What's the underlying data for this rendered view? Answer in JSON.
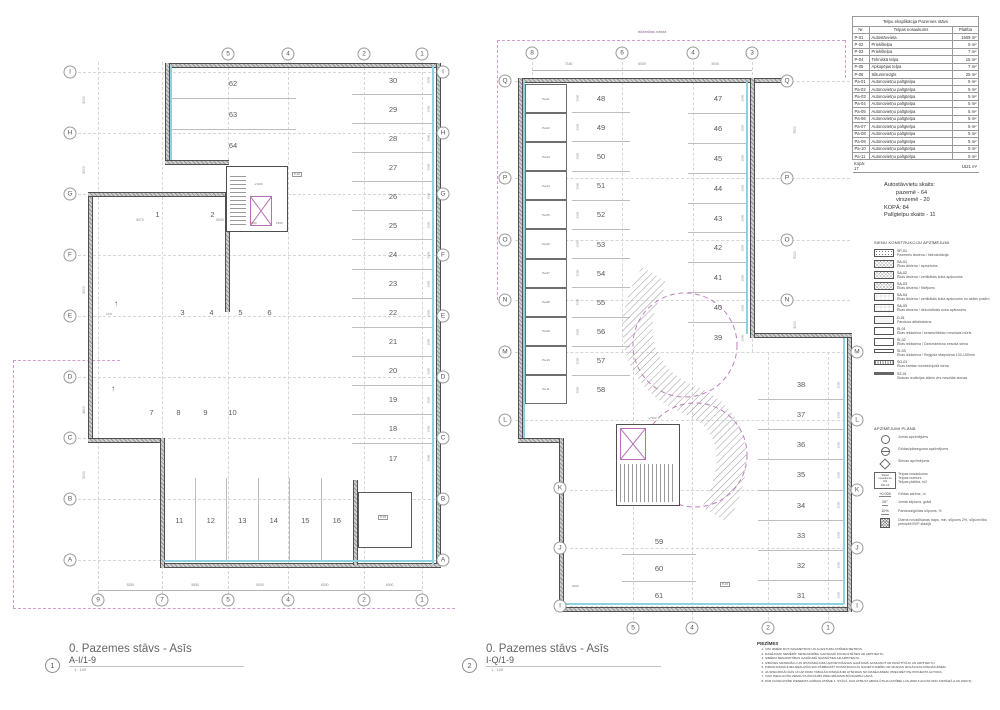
{
  "title_block_1": {
    "number": "1",
    "title": "0. Pazemes stāvs - Asīs",
    "drawing": "A-I/1-9",
    "scale": "1 : 100"
  },
  "title_block_2": {
    "number": "2",
    "title": "0. Pazemes stāvs - Asīs",
    "drawing": "I-Q/1-9",
    "scale": "1 : 100"
  },
  "room_table": {
    "title": "Telpu eksplikācija Pazemes stāvs",
    "headers": [
      "Nr.",
      "Telpas nosaukums",
      "Platība"
    ],
    "rows": [
      [
        "P-01",
        "Autostāvvieta",
        "1509 m²"
      ],
      [
        "P-02",
        "Priekštelpa",
        "5 m²"
      ],
      [
        "P-03",
        "Priekštelpa",
        "7 m²"
      ],
      [
        "P-04",
        "Tehniskā telpa",
        "15 m²"
      ],
      [
        "P-05",
        "Apkopējas telpa",
        "7 m²"
      ],
      [
        "P-06",
        "Siltummezgls",
        "25 m²"
      ],
      [
        "Pa-01",
        "Autonovietņu palīgtelpa",
        "5 m²"
      ],
      [
        "Pa-02",
        "Autonovietņu palīgtelpa",
        "5 m²"
      ],
      [
        "Pa-03",
        "Autonovietņu palīgtelpa",
        "5 m²"
      ],
      [
        "Pa-04",
        "Autonovietņu palīgtelpa",
        "5 m²"
      ],
      [
        "Pa-05",
        "Autonovietņu palīgtelpa",
        "5 m²"
      ],
      [
        "Pa-06",
        "Autonovietņu palīgtelpa",
        "5 m²"
      ],
      [
        "Pa-07",
        "Autonovietņu palīgtelpa",
        "5 m²"
      ],
      [
        "Pa-08",
        "Autonovietņu palīgtelpa",
        "5 m²"
      ],
      [
        "Pa-09",
        "Autonovietņu palīgtelpa",
        "5 m²"
      ],
      [
        "Pa-10",
        "Autonovietņu palīgtelpa",
        "5 m²"
      ],
      [
        "Pa-11",
        "Autonovietņu palīgtelpa",
        "5 m²"
      ]
    ],
    "footer": [
      "Kopā: 17",
      "",
      "1621 m²"
    ]
  },
  "counts": {
    "lines": [
      "Autostāvvietu skaits:",
      "pazemē - 64",
      "virszemē - 20",
      "KOPĀ: 84",
      "Palīgtelpu skaits - 11"
    ]
  },
  "wall_legend": {
    "title": "SIENU KONSTRUKCIJU APZĪMĒJUMI",
    "items": [
      {
        "code": "SP-01",
        "desc": "Pazemes ārsiena / hidroizolācija",
        "swatch": "sw-speckle"
      },
      {
        "code": "SA-01",
        "desc": "Ēkas ārsiena / apmetums",
        "swatch": "sw-cross"
      },
      {
        "code": "SA-02",
        "desc": "Ēkas ārsiena / vertikālais koka apšuvums",
        "swatch": "sw-cross"
      },
      {
        "code": "SA-03",
        "desc": "Ēkas ārsiena / flīzējums",
        "swatch": "sw-cross"
      },
      {
        "code": "SA-04",
        "desc": "Ēkas ārsiena / vertikālais koka apšuvums no abām pusēm",
        "swatch": "sw-circles"
      },
      {
        "code": "SA-05",
        "desc": "Ēkas ārsiena / dekoratīvais koka apšuvums",
        "swatch": "sw-circles"
      },
      {
        "code": "D-01",
        "desc": "Pandusa atbalstsiena",
        "swatch": "sw-light"
      },
      {
        "code": "SI-01",
        "desc": "Ēkas iekšsiena / keramzītbloku nesošais mūris",
        "swatch": "sw-lightdot"
      },
      {
        "code": "SI-02",
        "desc": "Ēkas iekšsiena / Dzelzsbetona nesošā siena",
        "swatch": "sw-lightdot"
      },
      {
        "code": "SI-03",
        "desc": "Ēkas iekšsiena / Reģipša starpsiena 100-150mm",
        "swatch": "sw-thin"
      },
      {
        "code": "SG-01",
        "desc": "Ēkas šahtas norobežojošā siena",
        "swatch": "sw-dotband"
      },
      {
        "code": "SZ-01",
        "desc": "Skaņas izolācijas slānis virs nesošās sienas",
        "swatch": "sw-solid"
      }
    ]
  },
  "plan_legend": {
    "title": "APZĪMĒJUMI PLĀNĀ",
    "items": [
      {
        "sym": "circle",
        "sym_text": "",
        "label": "Jumta apzīmējums"
      },
      {
        "sym": "circle2",
        "sym_text": "",
        "label": "Grīdas/pārseguma apzīmējums"
      },
      {
        "sym": "diamond",
        "sym_text": "",
        "label": "Sienas apzīmējums"
      },
      {
        "sym": "roombox",
        "sym_text": "Telpas nosaukums\nI-01\n100 m2",
        "label": "Telpas nosaukums\nTelpas numurs\nTelpas platība, m2"
      },
      {
        "sym": "text",
        "sym_text": "+0.000",
        "label": "Grīdas atzīme, m"
      },
      {
        "sym": "text",
        "sym_text": "26°",
        "label": "Jumta slīpums, grādi"
      },
      {
        "sym": "text",
        "sym_text": "10%",
        "label": "Pandusa/grīdas slīpums, %"
      },
      {
        "sym": "hatch",
        "sym_text": "",
        "label": "Ūdens novadīšanas traps, min. slīpums 2%, slīpumi tiks precizēti BVP stadijā"
      }
    ]
  },
  "notes": {
    "title": "PIEZĪMES",
    "items": [
      "VISI IZMĒRI DOTI MILIMETROS UN AUGSTUMA ATZĪMES METROS.",
      "RASĒJUMU NEMĒRĪT. NESKAIDRĪBU GADĪJUMĀ KONSULTĒTIES AR ARHITEKTU.",
      "IZMĒRU NESAKRITĪBAS GADĪJUMĀ SAZINĀTIES AR ARHITEKTU.",
      "IZBŪVES MATERIĀLU UN IZSTRĀDĀJUMU AIZVIETOŠANAS GADĪJUMĀ SASKAŅOT AR PASŪTĪTĀJU UN ARHITEKTU.",
      "PIRMS RISINĀJUMA REALIZĀCIJAS PĀRBAUDĪT KONSTRUKCIJU SAVIETOJAMĪBU AR SKAŅAS IZOLĀCIJAS RISINĀJUMIEM.",
      "JA SPECIFIKĀCIJĀS UN APJOMU TABULĀS RISINĀJUMI ATŠĶIRAS NO RASĒJUMIEM, PRECIZĒT PIE PROJEKTA AUTORA.",
      "VISU PIEGULOŠO ZEMJU PLĀNOJUMS PRECIZĒJAMS BŪVDARBU LAIKĀ.",
      "PAR ±0.000 ATZĪMI PIEŅEMTA GRĪDAS ATZĪME 1. STĀVĀ, KAS ATBILST ABSOLŪTAJAI ATZĪMEI LAS-2000,5 AUGSTUMU SISTĒMĀ (LAS 2000,5)."
    ]
  },
  "plan1": {
    "axes_left": [
      "I",
      "H",
      "G",
      "F",
      "E",
      "D",
      "C",
      "B",
      "A"
    ],
    "axes_right": [
      "I",
      "H",
      "G",
      "F",
      "E",
      "D",
      "C",
      "B",
      "A"
    ],
    "axes_top": [
      "5",
      "4",
      "2",
      "1"
    ],
    "axes_bottom": [
      "9",
      "7",
      "5",
      "4",
      "2",
      "1"
    ],
    "stalls_right_col": [
      "30",
      "29",
      "28",
      "27",
      "26",
      "25",
      "24",
      "23",
      "22",
      "21",
      "20",
      "19",
      "18",
      "17"
    ],
    "stalls_top_left": [
      "62",
      "63",
      "64"
    ],
    "stalls_bottom_row": [
      "11",
      "12",
      "13",
      "14",
      "15",
      "16"
    ],
    "stall_pair": [
      "1",
      "2"
    ],
    "row_a": [
      "3",
      "4",
      "5",
      "6"
    ],
    "row_b": [
      "7",
      "8",
      "9",
      "10"
    ],
    "dims_bottom": [
      "5250",
      "5550",
      "5000",
      "6300",
      "5000"
    ],
    "dims_mid": [
      "5070",
      "5000"
    ],
    "dims_core": [
      "7600",
      "1500"
    ],
    "dims_left": [
      "3000",
      "5000",
      "5000",
      "4600",
      "3000"
    ],
    "stall_dim": "2500",
    "elevation": "-2.900",
    "slope": "10%",
    "room_tag_core": "P-02",
    "room_tag_heat": "P-06"
  },
  "plan2": {
    "axes_left": [
      "Q",
      "P",
      "O",
      "N",
      "M",
      "L"
    ],
    "axes_left_inset": [
      "K",
      "J",
      "I"
    ],
    "axes_right_upper": [
      "Q",
      "P",
      "O",
      "N"
    ],
    "axes_right_lower": [
      "M",
      "L",
      "K",
      "J",
      "I"
    ],
    "axes_top": [
      "8",
      "6",
      "4",
      "3"
    ],
    "axes_bottom": [
      "5",
      "4",
      "2",
      "1"
    ],
    "stalls_left_col": [
      "48",
      "49",
      "50",
      "51",
      "52",
      "53",
      "54",
      "55",
      "56",
      "57",
      "58"
    ],
    "pa_rooms": [
      "Pa-01",
      "Pa-02",
      "Pa-03",
      "Pa-04",
      "Pa-05",
      "Pa-06",
      "Pa-07",
      "Pa-08",
      "Pa-09",
      "Pa-10",
      "Pa-11"
    ],
    "stalls_right_upper": [
      "47",
      "46",
      "45",
      "44",
      "43",
      "42",
      "41",
      "40",
      "39"
    ],
    "stalls_right_lower": [
      "38",
      "37",
      "36",
      "35",
      "34",
      "33",
      "32",
      "31"
    ],
    "stalls_bottom": [
      "59",
      "60",
      "61"
    ],
    "dims_top": [
      "7180",
      "6000",
      "5000"
    ],
    "dims_right": [
      "7500",
      "5000",
      "3000"
    ],
    "dims_bottom2": [
      "3000"
    ],
    "stall_dim": "2500",
    "elevation": "-2.900",
    "boundary_label": "būvtiesības robeža",
    "room_tag_core": "P-03"
  }
}
